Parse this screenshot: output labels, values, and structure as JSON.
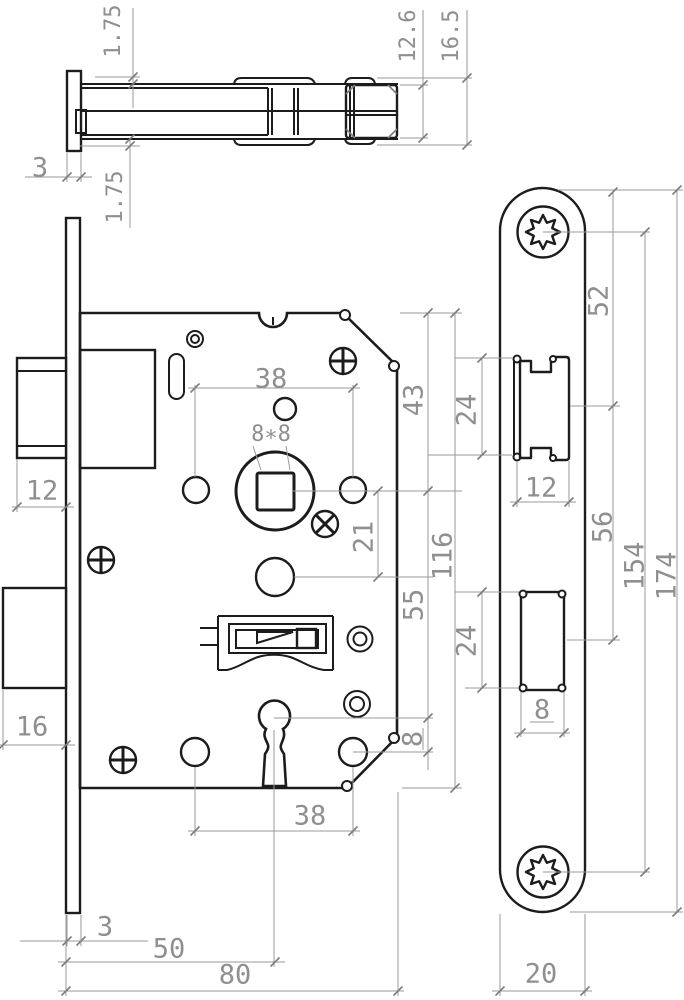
{
  "drawing": {
    "background": "#ffffff",
    "line_color": "#1c1c1c",
    "dim_line_color": "#9a9a9a",
    "dim_text_color": "#8f8f8f"
  },
  "dims": {
    "top_view": {
      "lip_top": "1.75",
      "lip_bottom": "1.75",
      "faceplate_thickness": "3",
      "latch_body_height": "12.6",
      "latch_overall_height": "16.5"
    },
    "front_view": {
      "hole_spacing_top": "38",
      "spindle_square": "8∗8",
      "top_to_spindle": "43",
      "latch_bolt_width": "12",
      "spindle_to_cylinder": "21",
      "cylinder_to_keyhole": "55",
      "case_height": "116",
      "deadbolt_width": "16",
      "keyhole_to_holes": "8",
      "hole_spacing_bottom": "38",
      "faceplate_thickness": "3",
      "backset": "50",
      "case_depth": "80"
    },
    "faceplate_view": {
      "top_to_latch_axis": "52",
      "latch_cutout_height": "24",
      "latch_cutout_width": "12",
      "latch_to_deadbolt_axis": "56",
      "screw_hole_spacing": "154",
      "plate_length": "174",
      "deadbolt_cutout_height": "24",
      "deadbolt_cutout_width": "8",
      "plate_width": "20"
    }
  }
}
